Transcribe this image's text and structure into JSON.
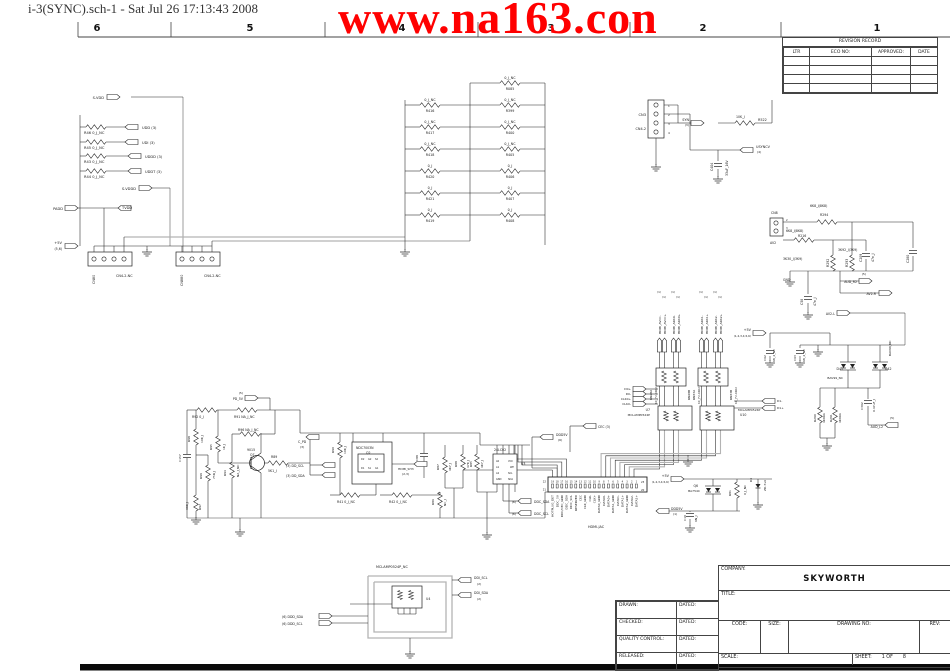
{
  "window_title": "i-3(SYNC).sch-1 - Sat Jul 26 17:13:43 2008",
  "watermark": {
    "text": "www.na163.con",
    "color": "#FF0000"
  },
  "ruler": {
    "columns": [
      {
        "label": "6",
        "x": 97
      },
      {
        "label": "5",
        "x": 250
      },
      {
        "label": "4",
        "x": 402
      },
      {
        "label": "3",
        "x": 551
      },
      {
        "label": "2",
        "x": 703
      },
      {
        "label": "1",
        "x": 877
      }
    ]
  },
  "revision_table": {
    "title": "REVISION RECORD",
    "headers": [
      "LTR",
      "ECO NO:",
      "APPROVED:",
      "DATE"
    ],
    "empty_rows": 4
  },
  "title_block": {
    "company_label": "COMPANY:",
    "company": "SKYWORTH",
    "title_label": "TITLE:",
    "approval_rows": [
      {
        "label": "DRAWN:",
        "dated": "DATED:"
      },
      {
        "label": "CHECKED:",
        "dated": "DATED:"
      },
      {
        "label": "QUALITY CONTROL:",
        "dated": "DATED:"
      },
      {
        "label": "RELEASED:",
        "dated": "DATED:"
      }
    ],
    "code_label": "CODE:",
    "size_label": "SIZE:",
    "drawing_label": "DRAWING NO:",
    "rev_label": "REV:",
    "scale_label": "SCALE:",
    "sheet_label": "SHEET:",
    "sheet_value": "1 OF",
    "sheet_total": "8"
  },
  "hdmi": {
    "label": "HDMI-JAC",
    "pin_numbers": [
      "19",
      "18",
      "17",
      "16",
      "15",
      "14",
      "13",
      "12",
      "11",
      "10",
      "9",
      "8",
      "7",
      "6",
      "5",
      "4",
      "3",
      "2",
      "1"
    ],
    "corner_pins": [
      "22",
      "21",
      "23",
      "20"
    ],
    "pin_names": [
      "HOTPLUG_DET",
      "DDC_5V",
      "DDC/CEC_GND",
      "DDC_SDA",
      "DDC_SCL",
      "RESERVED",
      "CEC",
      "CLK_GND",
      "CLK-",
      "CLK+",
      "DATA0_GND",
      "DATA0-",
      "DATA0+",
      "DATA1_GND",
      "DATA1-",
      "DATA1+",
      "DATA2_GND",
      "DATA2-",
      "DATA2+"
    ]
  },
  "labels": [
    [
      "S-VDD",
      104,
      99,
      3.6,
      0,
      "e"
    ],
    [
      "R46  0_J_NC",
      84,
      134
    ],
    [
      "UDD  (3)",
      142,
      129
    ],
    [
      "R45  0_J_NC",
      84,
      149
    ],
    [
      "UDI  (3)",
      142,
      144
    ],
    [
      "R43  0_J_NC",
      84,
      163
    ],
    [
      "UDDD  (3)",
      145,
      158
    ],
    [
      "R44  0_J_NC",
      84,
      178
    ],
    [
      "UDDT  (3)",
      145,
      173
    ],
    [
      "S-VDDD",
      136,
      190,
      3.6,
      0,
      "e"
    ],
    [
      "PADD",
      63,
      210,
      3.6,
      0,
      "e"
    ],
    [
      "TVDD",
      122,
      209
    ],
    [
      "+5V",
      62,
      244,
      3.6,
      0,
      "e"
    ],
    [
      "(5,6)",
      62,
      250,
      3.2,
      0,
      "e"
    ],
    [
      "CN80",
      95,
      284,
      3.4,
      -90
    ],
    [
      "CN4-2-NC",
      116,
      277,
      3.4
    ],
    [
      "CN880",
      183,
      286,
      3.4,
      -90
    ],
    [
      "CN4-2-NC",
      204,
      277,
      3.4
    ],
    [
      "0_J_NC",
      430,
      101,
      3.3,
      0,
      "m"
    ],
    [
      "R416",
      430,
      112,
      3.3,
      0,
      "m"
    ],
    [
      "0_J_NC",
      430,
      123,
      3.3,
      0,
      "m"
    ],
    [
      "R417",
      430,
      134,
      3.3,
      0,
      "m"
    ],
    [
      "0_J_NC",
      430,
      145,
      3.3,
      0,
      "m"
    ],
    [
      "R418",
      430,
      156,
      3.3,
      0,
      "m"
    ],
    [
      "0_J",
      430,
      167,
      3.3,
      0,
      "m"
    ],
    [
      "R420",
      430,
      178,
      3.3,
      0,
      "m"
    ],
    [
      "0_J",
      430,
      189,
      3.3,
      0,
      "m"
    ],
    [
      "R421",
      430,
      200,
      3.3,
      0,
      "m"
    ],
    [
      "0_J",
      430,
      211,
      3.3,
      0,
      "m"
    ],
    [
      "R419",
      430,
      222,
      3.3,
      0,
      "m"
    ],
    [
      "0_J_NC",
      510,
      79,
      3.3,
      0,
      "m"
    ],
    [
      "R085",
      510,
      90,
      3.3,
      0,
      "m"
    ],
    [
      "0_J_NC",
      510,
      101,
      3.3,
      0,
      "m"
    ],
    [
      "R399",
      510,
      112,
      3.3,
      0,
      "m"
    ],
    [
      "0_J_NC",
      510,
      123,
      3.3,
      0,
      "m"
    ],
    [
      "R400",
      510,
      134,
      3.3,
      0,
      "m"
    ],
    [
      "0_J_NC",
      510,
      145,
      3.3,
      0,
      "m"
    ],
    [
      "R405",
      510,
      156,
      3.3,
      0,
      "m"
    ],
    [
      "0_J",
      510,
      167,
      3.3,
      0,
      "m"
    ],
    [
      "R406",
      510,
      178,
      3.3,
      0,
      "m"
    ],
    [
      "0_J",
      510,
      189,
      3.3,
      0,
      "m"
    ],
    [
      "R407",
      510,
      200,
      3.3,
      0,
      "m"
    ],
    [
      "0_J",
      510,
      211,
      3.3,
      0,
      "m"
    ],
    [
      "R408",
      510,
      222,
      3.3,
      0,
      "m"
    ],
    [
      "CN3",
      646,
      116,
      3.6,
      0,
      "e"
    ],
    [
      "CN4-2",
      646,
      130,
      3.4,
      0,
      "e"
    ],
    [
      "1",
      668,
      107,
      2.8
    ],
    [
      "2",
      668,
      116,
      2.8
    ],
    [
      "3",
      668,
      125,
      2.8
    ],
    [
      "4",
      668,
      134,
      2.8
    ],
    [
      "SYN",
      689,
      121,
      3.4,
      0,
      "e"
    ],
    [
      "(3)",
      689,
      126,
      3,
      0,
      "e"
    ],
    [
      "10K_J",
      736,
      118,
      3.2
    ],
    [
      "R522",
      758,
      121,
      3.4
    ],
    [
      "USYNCV",
      756,
      148,
      3.4
    ],
    [
      "(4)",
      757,
      153,
      3
    ],
    [
      "C404",
      713,
      171,
      3.2,
      -90
    ],
    [
      "33uF_16V",
      728,
      176,
      3.2,
      -90
    ],
    [
      "6K8_J(8K8)",
      810,
      207,
      3.2
    ],
    [
      "R294",
      820,
      216,
      3.2
    ],
    [
      "CN8",
      771,
      214,
      3.2
    ],
    [
      "2",
      786,
      221,
      2.6
    ],
    [
      "3",
      786,
      229,
      2.6
    ],
    [
      "6K8_J(8K8)",
      786,
      232,
      3.2
    ],
    [
      "R216",
      798,
      237,
      3.2
    ],
    [
      "AV2",
      770,
      244,
      3.2
    ],
    [
      "3K30_J(3K9)",
      783,
      260,
      3.2
    ],
    [
      "R292",
      829,
      267,
      3.2,
      -90
    ],
    [
      "3K92_J(3K9)",
      838,
      251,
      3.2
    ],
    [
      "R293",
      848,
      267,
      3.2,
      -90
    ],
    [
      "C209",
      862,
      262,
      3.2,
      -90
    ],
    [
      "47n_J",
      874,
      262,
      3.2,
      -90
    ],
    [
      "C280",
      909,
      263,
      3.2,
      -90
    ],
    [
      "GND",
      783,
      281,
      3.2
    ],
    [
      "C58",
      803,
      305,
      3.2,
      -90
    ],
    [
      "47n_J",
      816,
      306,
      3.2,
      -90
    ],
    [
      "(5)",
      866,
      275,
      3,
      0,
      "e"
    ],
    [
      "AUD_R2",
      857,
      283,
      3.2,
      0,
      "e"
    ],
    [
      "AV2-R",
      876,
      295,
      3.2,
      0,
      "e"
    ],
    [
      "AV2-L",
      835,
      315,
      3.2,
      0,
      "e"
    ],
    [
      "C62",
      766,
      361,
      3,
      -90
    ],
    [
      "68_2_NC",
      775,
      362,
      3,
      -90
    ],
    [
      "C63",
      796,
      361,
      3,
      -90
    ],
    [
      "68_2_NC",
      805,
      362,
      3,
      -90
    ],
    [
      "+5V",
      751,
      331,
      3.4,
      0,
      "e"
    ],
    [
      "(1,2,3,4,5,6)",
      751,
      337,
      2.8,
      0,
      "e"
    ],
    [
      "D41",
      843,
      370,
      3.2,
      0,
      "e"
    ],
    [
      "BAV99_NC",
      843,
      379,
      3,
      0,
      "e"
    ],
    [
      "D42",
      885,
      370,
      3.2
    ],
    [
      "BAV99_NC",
      891,
      356,
      3,
      -90
    ],
    [
      "R290",
      816,
      422,
      3,
      -90
    ],
    [
      "4K99A",
      825,
      423,
      3,
      -90
    ],
    [
      "R291",
      832,
      422,
      3,
      -90
    ],
    [
      "4K99A",
      841,
      423,
      3,
      -90
    ],
    [
      "C302",
      863,
      410,
      3,
      -90
    ],
    [
      "0.47uF_J",
      875,
      412,
      3,
      -90
    ],
    [
      "(5)",
      890,
      419,
      3
    ],
    [
      "AUD_L2",
      883,
      428,
      3.2,
      0,
      "e"
    ],
    [
      "HDMI_AVCC-",
      661,
      334,
      3,
      -90
    ],
    [
      "HDMI_AVCC+",
      666,
      334,
      3,
      -90
    ],
    [
      "HDMI_ARX0-",
      675,
      334,
      3,
      -90
    ],
    [
      "HDMI_ARX0+",
      680,
      334,
      3,
      -90
    ],
    [
      "HDMI_ARX1-",
      703,
      334,
      3,
      -90
    ],
    [
      "HDMI_ARX1+",
      708,
      334,
      3,
      -90
    ],
    [
      "HDMI_ARX2-",
      717,
      334,
      3,
      -90
    ],
    [
      "HDMI_ARX2+",
      722,
      334,
      3,
      -90
    ],
    [
      "(1)",
      657,
      293,
      2.8
    ],
    [
      "(1)",
      662,
      298,
      2.8
    ],
    [
      "(1)",
      671,
      293,
      2.8
    ],
    [
      "(1)",
      676,
      298,
      2.8
    ],
    [
      "(1)",
      699,
      293,
      2.8
    ],
    [
      "(1)",
      704,
      298,
      2.8
    ],
    [
      "(1)",
      713,
      293,
      2.8
    ],
    [
      "(1)",
      718,
      298,
      2.8
    ],
    [
      "RN28A",
      652,
      400,
      3,
      -90
    ],
    [
      "10_J*2-0402",
      657,
      404,
      2.8,
      -90
    ],
    [
      "RN28B",
      690,
      400,
      3,
      -90
    ],
    [
      "RN33A",
      695,
      400,
      3,
      -90
    ],
    [
      "10_J*2-0402",
      700,
      404,
      2.8,
      -90
    ],
    [
      "RN33B",
      732,
      400,
      3,
      -90
    ],
    [
      "10_J*2-0402",
      737,
      404,
      2.8,
      -90
    ],
    [
      "U7",
      650,
      411,
      3.2,
      0,
      "e"
    ],
    [
      "MCLAMP0524P",
      650,
      416,
      3,
      0,
      "e"
    ],
    [
      "MCLAMP0524P",
      738,
      411,
      3
    ],
    [
      "U10",
      740,
      416,
      3.2
    ],
    [
      "D0+",
      631,
      390,
      3,
      0,
      "e"
    ],
    [
      "D0-",
      631,
      395,
      3,
      0,
      "e"
    ],
    [
      "CLK0+",
      631,
      400,
      3,
      0,
      "e"
    ],
    [
      "CLK0-",
      631,
      405,
      3,
      0,
      "e"
    ],
    [
      "D1-",
      777,
      402,
      3
    ],
    [
      "D1+",
      777,
      409,
      3
    ],
    [
      "CEC  (3)",
      598,
      428,
      3.2
    ],
    [
      "DDD5V",
      556,
      436,
      3.2
    ],
    [
      "(6)",
      558,
      441,
      3
    ],
    [
      "+5V",
      669,
      477,
      3.4,
      0,
      "e"
    ],
    [
      "(1,2,3,4,5,6)",
      669,
      483,
      2.8,
      0,
      "e"
    ],
    [
      "Q6",
      698,
      487,
      3.2,
      0,
      "e"
    ],
    [
      "BA754C",
      700,
      492,
      3,
      0,
      "e"
    ],
    [
      "R81",
      731,
      496,
      3,
      -90
    ],
    [
      "0_J_NC",
      746,
      495,
      3,
      -90
    ],
    [
      "D4",
      752,
      482,
      3,
      -90
    ],
    [
      "ZD-5v6",
      766,
      491,
      3,
      -90
    ],
    [
      "DDD5V",
      671,
      510,
      3.2
    ],
    [
      "(1)",
      673,
      515,
      3
    ],
    [
      "C10",
      686,
      521,
      3,
      -90
    ],
    [
      "6N_J",
      697,
      522,
      3,
      -90
    ],
    [
      "24LC02",
      494,
      451,
      3.2
    ],
    [
      "U3",
      521,
      465,
      3.2
    ],
    [
      "A0",
      496,
      462,
      2.4
    ],
    [
      "A1",
      496,
      468,
      2.4
    ],
    [
      "A2",
      496,
      474,
      2.4
    ],
    [
      "GND",
      496,
      480,
      2.4
    ],
    [
      "VCC",
      508,
      462,
      2.4
    ],
    [
      "WP",
      510,
      468,
      2.4
    ],
    [
      "SCL",
      508,
      474,
      2.4
    ],
    [
      "SDA",
      508,
      480,
      2.4
    ],
    [
      "R85",
      472,
      467,
      3,
      -90
    ],
    [
      "4K7_J",
      483,
      468,
      3,
      -90
    ],
    [
      "(6)",
      516,
      503,
      3,
      0,
      "e"
    ],
    [
      "DDC_SDA",
      534,
      503,
      3.2
    ],
    [
      "(6)",
      516,
      515,
      3,
      0,
      "e"
    ],
    [
      "DDC_SCL",
      534,
      515,
      3.2
    ],
    [
      "R87",
      439,
      470,
      3,
      -90
    ],
    [
      "4K7_J",
      451,
      471,
      3,
      -90
    ],
    [
      "R88",
      457,
      467,
      3,
      -90
    ],
    [
      "47K_J",
      469,
      468,
      3,
      -90
    ],
    [
      "R86",
      434,
      505,
      3,
      -90
    ],
    [
      "NC_J",
      446,
      506,
      3,
      -90
    ],
    [
      "C88",
      418,
      461,
      3,
      -90
    ],
    [
      "NDC7003N",
      356,
      449,
      3.2
    ],
    [
      "Q2",
      366,
      454,
      3.2
    ],
    [
      "R90",
      334,
      453,
      3,
      -90
    ],
    [
      "10K_J",
      346,
      454,
      3,
      -90
    ],
    [
      "D2",
      361,
      460,
      2.4
    ],
    [
      "G2",
      368,
      460,
      2.4
    ],
    [
      "S2",
      375,
      460,
      2.4
    ],
    [
      "D1",
      361,
      469,
      2.4
    ],
    [
      "S1",
      368,
      469,
      2.4
    ],
    [
      "G1",
      375,
      469,
      2.4
    ],
    [
      "HDMI_SH3",
      398,
      470,
      3
    ],
    [
      "(2,3)",
      402,
      475,
      3
    ],
    [
      "R41  0_J_NC",
      337,
      503,
      3.2
    ],
    [
      "R42  0_J_NC",
      389,
      503,
      3.2
    ],
    [
      "(5)",
      243,
      394,
      3,
      0,
      "e"
    ],
    [
      "PD_5V",
      243,
      400,
      3.2,
      0,
      "e"
    ],
    [
      "R92  0_J",
      192,
      418,
      3.2
    ],
    [
      "R91  NA_J_NC",
      234,
      418,
      3.2
    ],
    [
      "R98",
      190,
      442,
      3,
      -90
    ],
    [
      "10K_J",
      203,
      443,
      3,
      -90
    ],
    [
      "C157",
      181,
      462,
      3,
      -90
    ],
    [
      "R95",
      212,
      450,
      3,
      -90
    ],
    [
      "1K_J",
      225,
      450,
      3,
      -90
    ],
    [
      "R96  NA_J_NC",
      238,
      431,
      3.2
    ],
    [
      "R99",
      202,
      479,
      3,
      -90
    ],
    [
      "75R_J",
      215,
      479,
      3,
      -90
    ],
    [
      "R94",
      226,
      476,
      3,
      -90
    ],
    [
      "NA_J_NC",
      239,
      477,
      3,
      -90
    ],
    [
      "9015",
      247,
      451,
      3.2
    ],
    [
      "Q7",
      250,
      456,
      3.2
    ],
    [
      "R89",
      271,
      458,
      3.2
    ],
    [
      "5K1_J",
      268,
      472,
      3.2
    ],
    [
      "39K_J",
      188,
      510,
      3,
      -90
    ],
    [
      "R97",
      201,
      510,
      3,
      -90
    ],
    [
      "C_PD",
      298,
      443,
      3.2
    ],
    [
      "(3)",
      300,
      448,
      3
    ],
    [
      "(3)  DD_SCL",
      286,
      467,
      3.2
    ],
    [
      "(3)  DD_SDA",
      286,
      477,
      3.2
    ],
    [
      "MCLAMP0524P_NC",
      376,
      568,
      3.4
    ],
    [
      "U4",
      426,
      600,
      3.2
    ],
    [
      "DDI_SCL",
      474,
      579,
      3.2
    ],
    [
      "(2)",
      477,
      585,
      3
    ],
    [
      "DDI_SDA",
      474,
      594,
      3.2
    ],
    [
      "(2)",
      477,
      600,
      3
    ],
    [
      "(6)  DDD_SDA",
      282,
      618,
      3.2
    ],
    [
      "(6)  DDD_SCL",
      282,
      625,
      3.2
    ]
  ]
}
